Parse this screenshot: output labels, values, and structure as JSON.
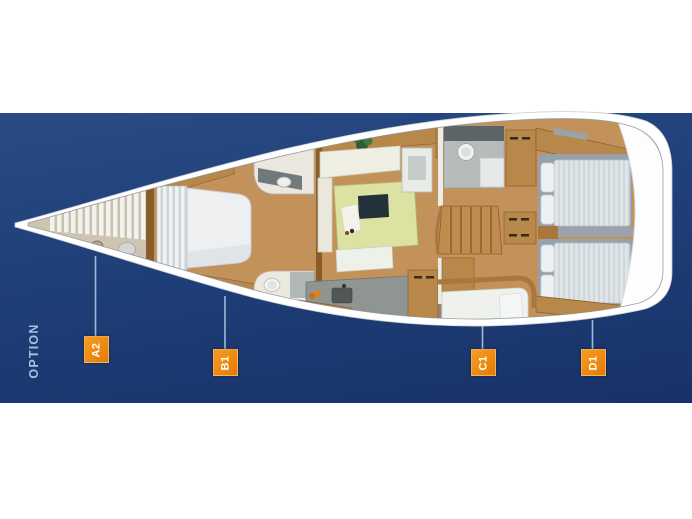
{
  "figure": {
    "option_label": "OPTION",
    "cabin_labels": [
      {
        "id": "A2"
      },
      {
        "id": "B1"
      },
      {
        "id": "C1"
      },
      {
        "id": "D1"
      }
    ],
    "colors": {
      "page_background": "#ffffff",
      "band_blue_top": "#2b4b86",
      "band_blue_bottom": "#163268",
      "label_orange": "#ee8a12",
      "label_text": "#ffffff",
      "connector_line": "#a3b8d8",
      "option_text": "#a9c0e2",
      "hull_white": "#ffffff",
      "wood_brown": "#b8874a",
      "floor_brown": "#c2925a",
      "mattress_gray": "#dfe4e7"
    }
  }
}
